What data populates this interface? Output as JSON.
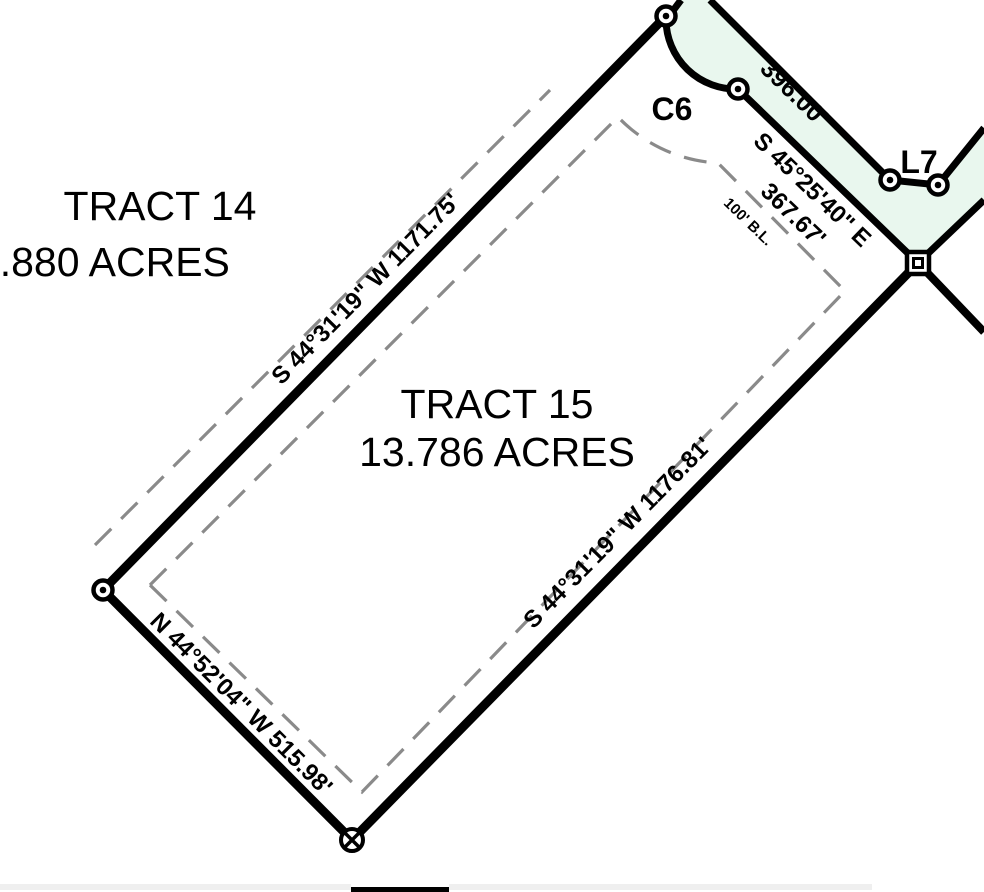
{
  "document": {
    "type": "survey-plat",
    "tract15": {
      "title": "TRACT 15",
      "acreage": "13.786 ACRES"
    },
    "tract14": {
      "title": "TRACT 14",
      "acreage": "14.880 ACRES"
    },
    "bearings": {
      "nw_boundary": "S 44°31'19\" W 1171.75'",
      "se_boundary": "S 44°31'19\" W 1176.81'",
      "sw_boundary": "N 44°52'04\" W 515.98'",
      "road_outer_distance": "396.00'",
      "road_inner_bearing": "S 45°25'40\" E",
      "road_inner_distance": "367.67'"
    },
    "labels": {
      "curve": "C6",
      "segment": "L7",
      "building_line": "100' B.L."
    },
    "colors": {
      "background": "#ffffff",
      "line": "#000000",
      "road_fill": "#e9f7ee",
      "dashed_line": "#8a8a8a",
      "building_line_text": "#8a8a8a",
      "faint_text": "#ececec",
      "scroll_track": "#efefef",
      "scroll_thumb": "#000000"
    }
  }
}
